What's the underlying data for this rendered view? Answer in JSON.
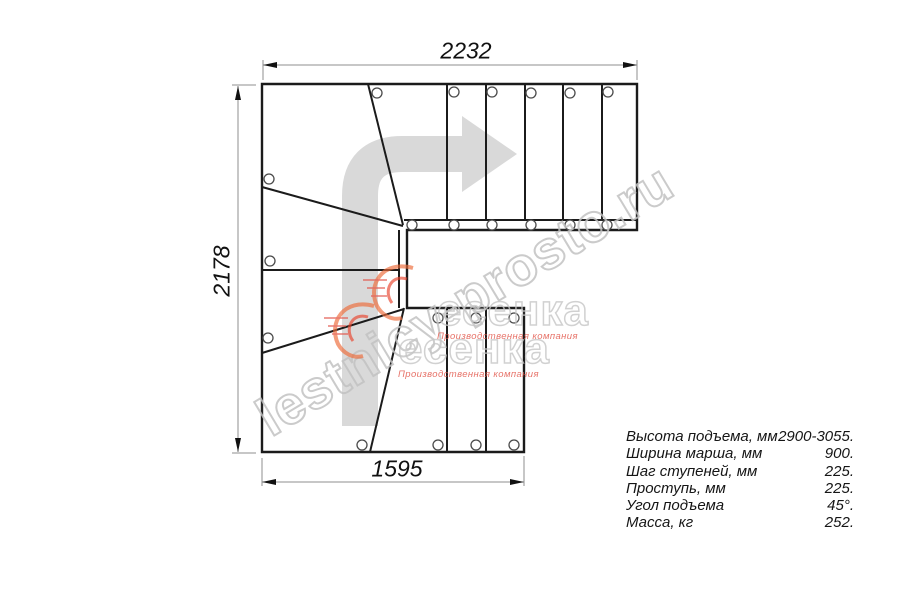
{
  "drawing": {
    "title": "staircase floor plan",
    "dimensions": {
      "top_mm": "2232",
      "left_mm": "2178",
      "bottom_mm": "1595"
    },
    "specs": {
      "rows": [
        {
          "label": "Высота подъема, мм",
          "value": "2900-3055."
        },
        {
          "label": "Ширина марша, мм",
          "value": "900."
        },
        {
          "label": "Шаг ступеней, мм",
          "value": "225."
        },
        {
          "label": "Проступь, мм",
          "value": "225."
        },
        {
          "label": "Угол подъема",
          "value": "45°."
        },
        {
          "label": "Масса, кг",
          "value": "252."
        }
      ]
    },
    "watermark": {
      "url": "lestnicy-prosto.ru",
      "logo_text": "есенка",
      "logo_subtitle": "Производственная компания"
    },
    "colors": {
      "line": "#1b1b1b",
      "dimension_line": "#8f8f8f",
      "direction_arrow_fill": "#d9d9d9",
      "watermark_gray": "#c2c2c2",
      "brand_red": "#e25549",
      "brand_orange": "#ee6a38"
    }
  }
}
